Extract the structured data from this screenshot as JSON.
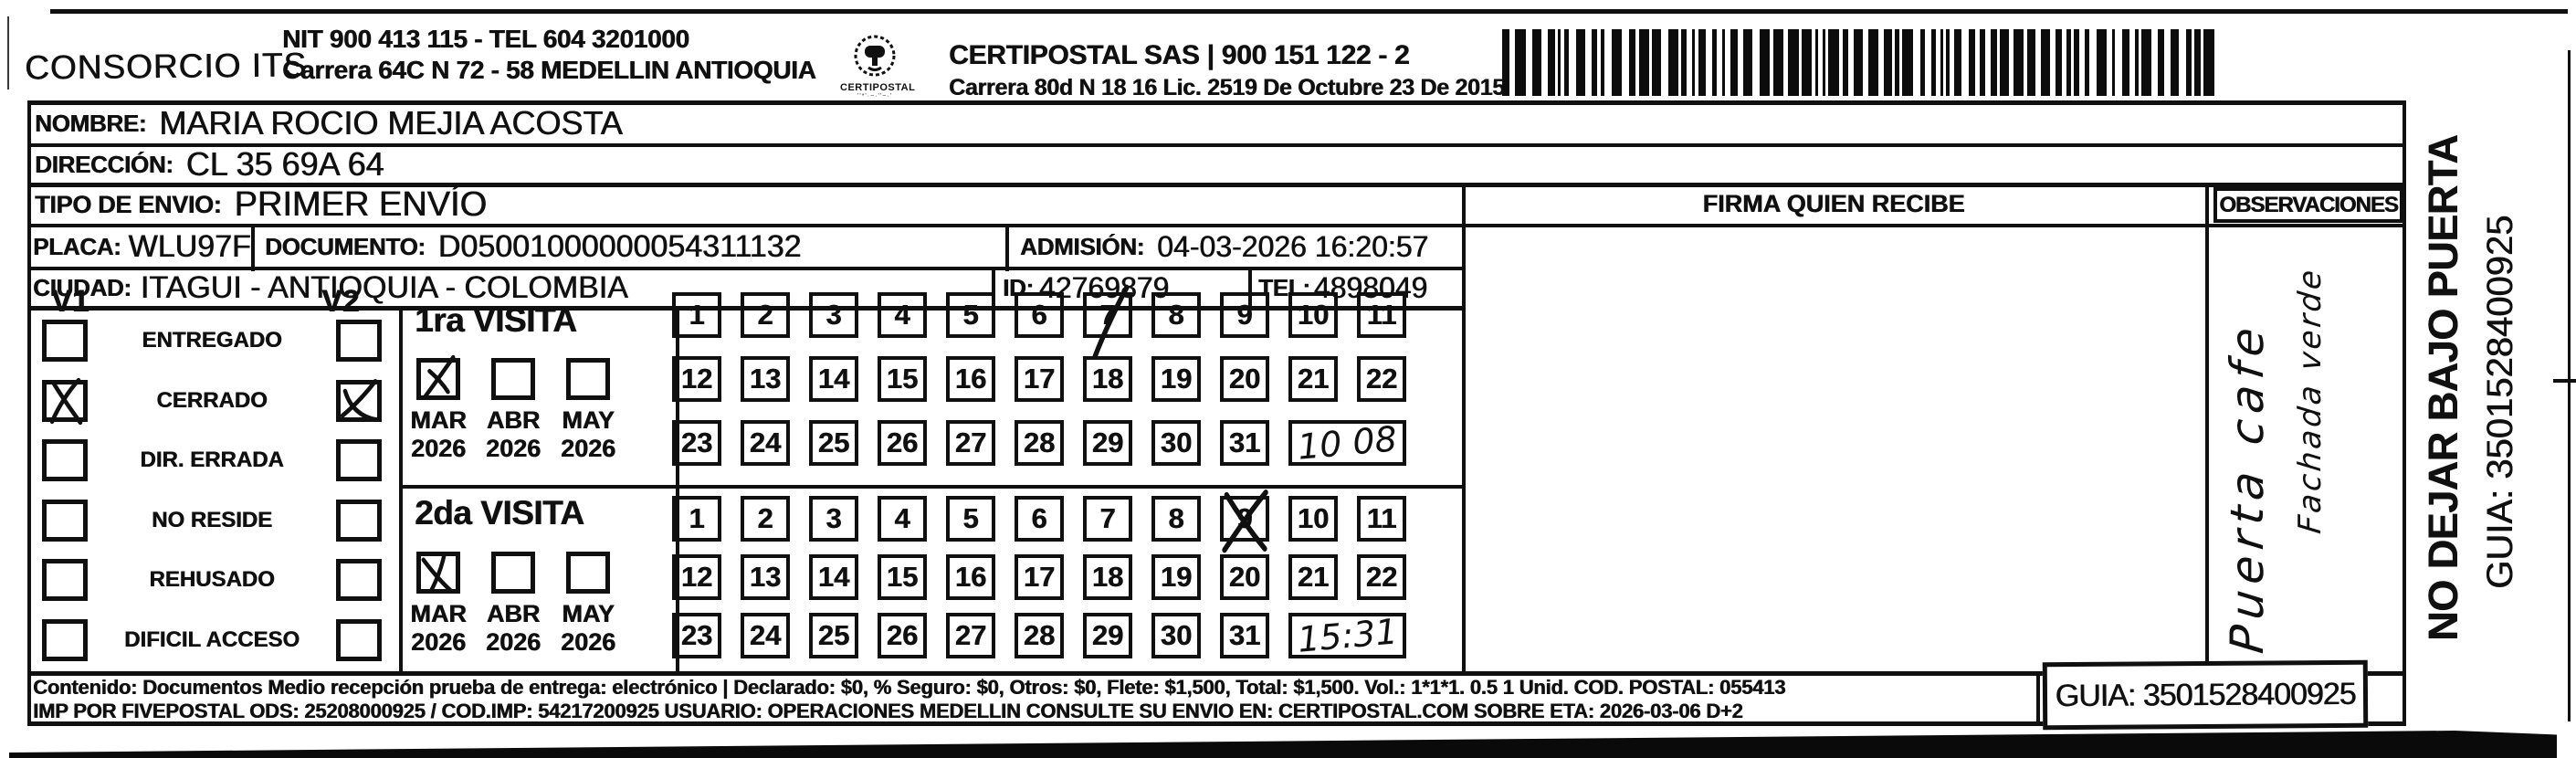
{
  "header": {
    "company": "CONSORCIO ITS",
    "nit_line1": "NIT 900 413 115 - TEL 604 3201000",
    "nit_line2": "Carrera 64C N 72 - 58 MEDELLIN ANTIOQUIA",
    "logo_caption": "CERTIPOSTAL",
    "certipostal_line1": "CERTIPOSTAL SAS | 900 151 122 - 2",
    "certipostal_line2": "Carrera 80d N 18 16  Lic. 2519 De Octubre 23 De 2015"
  },
  "shipment": {
    "nombre_label": "NOMBRE:",
    "nombre": "MARIA ROCIO MEJIA ACOSTA",
    "direccion_label": "DIRECCIÓN:",
    "direccion": "CL 35 69A 64",
    "tipo_envio_label": "TIPO DE ENVIO:",
    "tipo_envio": "PRIMER ENVÍO",
    "placa_label": "PLACA:",
    "placa": "WLU97F",
    "documento_label": "DOCUMENTO:",
    "documento": "D05001000000054311132",
    "admision_label": "ADMISIÓN:",
    "admision": "04-03-2026 16:20:57",
    "ciudad_label": "CIUDAD:",
    "ciudad": "ITAGUI - ANTIOQUIA - COLOMBIA",
    "id_label": "ID:",
    "id_value": "42769879",
    "tel_label": "TEL:",
    "tel": "4898049"
  },
  "status": {
    "v1_label": "V1",
    "v2_label": "V2",
    "options": [
      {
        "label": "ENTREGADO",
        "v1": false,
        "v2": false
      },
      {
        "label": "CERRADO",
        "v1": true,
        "v2": true
      },
      {
        "label": "DIR. ERRADA",
        "v1": false,
        "v2": false
      },
      {
        "label": "NO RESIDE",
        "v1": false,
        "v2": false
      },
      {
        "label": "REHUSADO",
        "v1": false,
        "v2": false
      },
      {
        "label": "DIFICIL ACCESO",
        "v1": false,
        "v2": false
      }
    ]
  },
  "day_numbers": [
    1,
    2,
    3,
    4,
    5,
    6,
    7,
    8,
    9,
    10,
    11,
    12,
    13,
    14,
    15,
    16,
    17,
    18,
    19,
    20,
    21,
    22,
    23,
    24,
    25,
    26,
    27,
    28,
    29,
    30,
    31
  ],
  "visits": [
    {
      "title": "1ra VISITA",
      "months": [
        {
          "label": "MAR",
          "year": "2026",
          "checked": true
        },
        {
          "label": "ABR",
          "year": "2026",
          "checked": false
        },
        {
          "label": "MAY",
          "year": "2026",
          "checked": false
        }
      ],
      "marked_day": 7,
      "mark_style": "slash",
      "time": "10 08"
    },
    {
      "title": "2da VISITA",
      "months": [
        {
          "label": "MAR",
          "year": "2026",
          "checked": true
        },
        {
          "label": "ABR",
          "year": "2026",
          "checked": false
        },
        {
          "label": "MAY",
          "year": "2026",
          "checked": false
        }
      ],
      "marked_day": 9,
      "mark_style": "cross",
      "time": "15:31"
    }
  ],
  "firma": {
    "header": "FIRMA QUIEN RECIBE"
  },
  "observaciones": {
    "header": "OBSERVACIONES",
    "handwriting_line1": "Puerta cafe",
    "handwriting_line2": "Fachada verde"
  },
  "side": {
    "warning": "NO DEJAR BAJO PUERTA",
    "guia": "GUIA: 3501528400925"
  },
  "footer": {
    "line1": "Contenido: Documentos Medio recepción prueba de entrega: electrónico | Declarado: $0, % Seguro: $0, Otros: $0, Flete: $1,500, Total: $1,500. Vol.: 1*1*1. 0.5 1 Unid. COD. POSTAL: 055413",
    "line2": "IMP POR FIVEPOSTAL ODS: 25208000925 / COD.IMP: 54217200925 USUARIO: OPERACIONES MEDELLIN CONSULTE SU ENVIO EN: CERTIPOSTAL.COM SOBRE ETA: 2026-03-06 D+2",
    "guia_box": "GUIA: 3501528400925"
  },
  "colors": {
    "ink": "#101010",
    "paper": "#ffffff"
  }
}
